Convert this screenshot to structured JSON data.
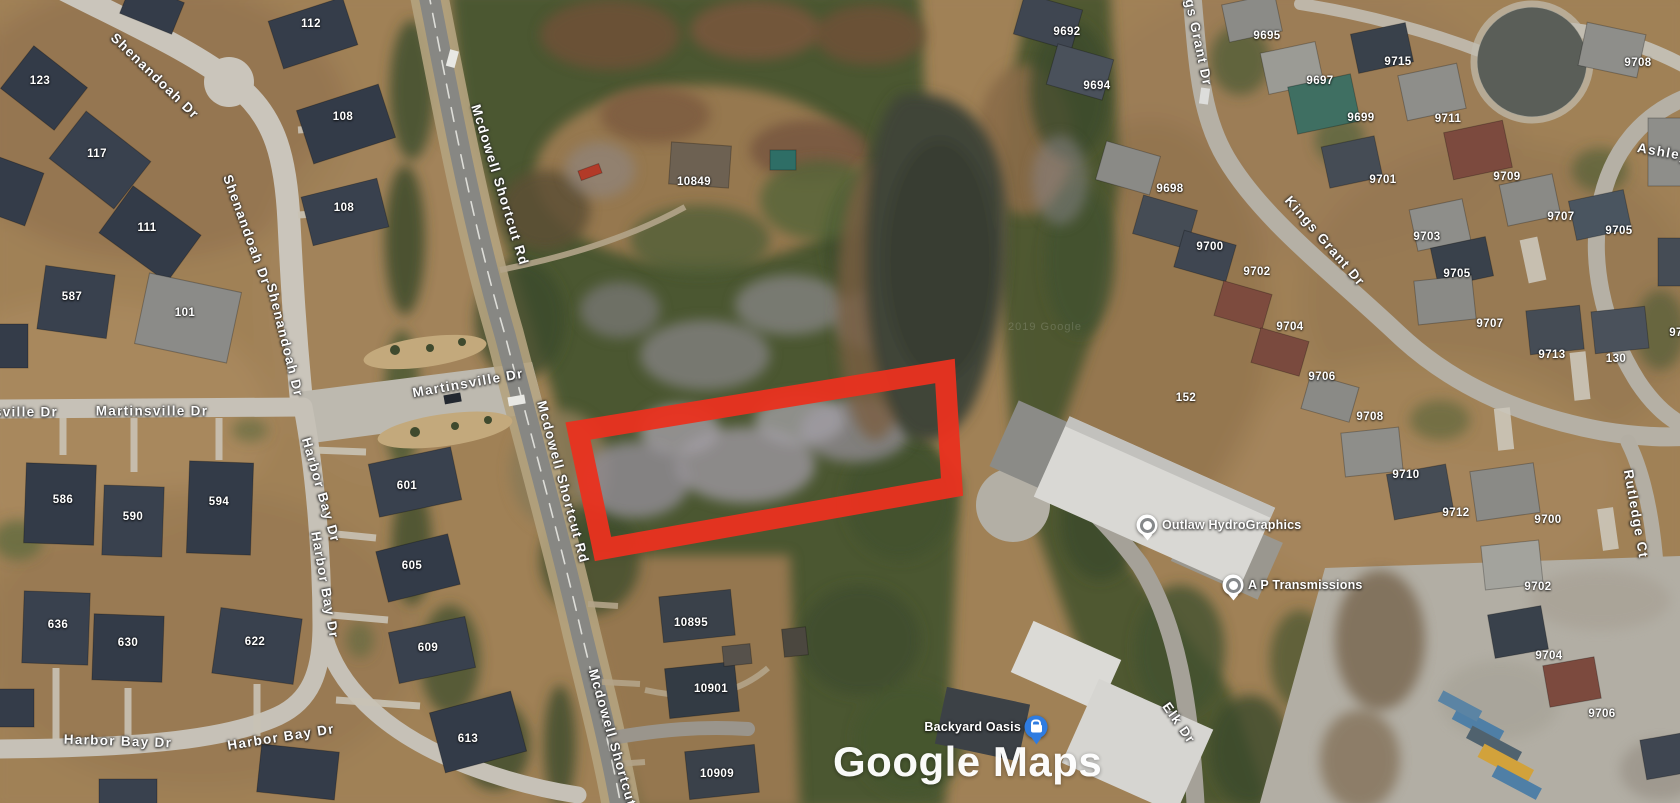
{
  "map": {
    "view_type": "satellite",
    "logo": {
      "text": "Google Maps"
    },
    "watermark": {
      "text": "2019 Google"
    },
    "street_labels": [
      {
        "text": "Shenandoah Dr",
        "x": 155,
        "y": 76,
        "rot": 44
      },
      {
        "text": "Shenandoah Dr",
        "x": 247,
        "y": 230,
        "rot": 70
      },
      {
        "text": "Shenandoah Dr",
        "x": 285,
        "y": 340,
        "rot": 76
      },
      {
        "text": "Mcdowell Shortcut Rd",
        "x": 500,
        "y": 185,
        "rot": 73
      },
      {
        "text": "Mcdowell Shortcut Rd",
        "x": 563,
        "y": 482,
        "rot": 75
      },
      {
        "text": "Mcdowell Shortcut Rd",
        "x": 616,
        "y": 750,
        "rot": 74
      },
      {
        "text": "sville Dr",
        "x": 26,
        "y": 412,
        "rot": 0
      },
      {
        "text": "Martinsville Dr",
        "x": 152,
        "y": 411,
        "rot": 0
      },
      {
        "text": "Martinsville Dr",
        "x": 468,
        "y": 383,
        "rot": -10
      },
      {
        "text": "Harbor Bay Dr",
        "x": 321,
        "y": 490,
        "rot": 74
      },
      {
        "text": "Harbor Bay Dr",
        "x": 325,
        "y": 585,
        "rot": 80
      },
      {
        "text": "Harbor Bay Dr",
        "x": 118,
        "y": 741,
        "rot": 2
      },
      {
        "text": "Harbor Bay Dr",
        "x": 281,
        "y": 737,
        "rot": -9
      },
      {
        "text": "Kings Grant Dr",
        "x": 1196,
        "y": 30,
        "rot": 78
      },
      {
        "text": "Kings Grant Dr",
        "x": 1325,
        "y": 241,
        "rot": 49
      },
      {
        "text": "Elk Dr",
        "x": 1179,
        "y": 723,
        "rot": 55
      },
      {
        "text": "Rutledge Ct",
        "x": 1636,
        "y": 514,
        "rot": 80
      },
      {
        "text": "Ashley",
        "x": 1663,
        "y": 152,
        "rot": 10
      }
    ],
    "house_numbers": [
      {
        "text": "112",
        "x": 311,
        "y": 24
      },
      {
        "text": "123",
        "x": 40,
        "y": 81
      },
      {
        "text": "117",
        "x": 97,
        "y": 154
      },
      {
        "text": "108",
        "x": 343,
        "y": 117
      },
      {
        "text": "108",
        "x": 344,
        "y": 208
      },
      {
        "text": "111",
        "x": 147,
        "y": 228
      },
      {
        "text": "587",
        "x": 72,
        "y": 297
      },
      {
        "text": "101",
        "x": 185,
        "y": 313
      },
      {
        "text": "586",
        "x": 63,
        "y": 500
      },
      {
        "text": "590",
        "x": 133,
        "y": 517
      },
      {
        "text": "594",
        "x": 219,
        "y": 502
      },
      {
        "text": "601",
        "x": 407,
        "y": 486
      },
      {
        "text": "605",
        "x": 412,
        "y": 566
      },
      {
        "text": "609",
        "x": 428,
        "y": 648
      },
      {
        "text": "613",
        "x": 468,
        "y": 739
      },
      {
        "text": "636",
        "x": 58,
        "y": 625
      },
      {
        "text": "630",
        "x": 128,
        "y": 643
      },
      {
        "text": "622",
        "x": 255,
        "y": 642
      },
      {
        "text": "10849",
        "x": 694,
        "y": 182
      },
      {
        "text": "10895",
        "x": 691,
        "y": 623
      },
      {
        "text": "10901",
        "x": 711,
        "y": 689
      },
      {
        "text": "10909",
        "x": 717,
        "y": 774
      },
      {
        "text": "9692",
        "x": 1067,
        "y": 32
      },
      {
        "text": "9694",
        "x": 1097,
        "y": 86
      },
      {
        "text": "9695",
        "x": 1267,
        "y": 36
      },
      {
        "text": "9697",
        "x": 1320,
        "y": 81
      },
      {
        "text": "9699",
        "x": 1361,
        "y": 118
      },
      {
        "text": "9715",
        "x": 1398,
        "y": 62
      },
      {
        "text": "9711",
        "x": 1448,
        "y": 119
      },
      {
        "text": "9708",
        "x": 1638,
        "y": 63
      },
      {
        "text": "9698",
        "x": 1170,
        "y": 189
      },
      {
        "text": "9700",
        "x": 1210,
        "y": 247
      },
      {
        "text": "9702",
        "x": 1257,
        "y": 272
      },
      {
        "text": "9701",
        "x": 1383,
        "y": 180
      },
      {
        "text": "9709",
        "x": 1507,
        "y": 177
      },
      {
        "text": "9707",
        "x": 1561,
        "y": 217
      },
      {
        "text": "9705",
        "x": 1619,
        "y": 231
      },
      {
        "text": "9703",
        "x": 1427,
        "y": 237
      },
      {
        "text": "9705",
        "x": 1457,
        "y": 274
      },
      {
        "text": "9704",
        "x": 1290,
        "y": 327
      },
      {
        "text": "9706",
        "x": 1322,
        "y": 377
      },
      {
        "text": "9708",
        "x": 1370,
        "y": 417
      },
      {
        "text": "152",
        "x": 1186,
        "y": 398
      },
      {
        "text": "9707",
        "x": 1490,
        "y": 324
      },
      {
        "text": "9713",
        "x": 1552,
        "y": 355
      },
      {
        "text": "130",
        "x": 1616,
        "y": 359
      },
      {
        "text": "97",
        "x": 1676,
        "y": 333
      },
      {
        "text": "9710",
        "x": 1406,
        "y": 475
      },
      {
        "text": "9712",
        "x": 1456,
        "y": 513
      },
      {
        "text": "9700",
        "x": 1548,
        "y": 520
      },
      {
        "text": "9702",
        "x": 1538,
        "y": 587
      },
      {
        "text": "9704",
        "x": 1549,
        "y": 656
      },
      {
        "text": "9706",
        "x": 1602,
        "y": 714
      }
    ],
    "places": [
      {
        "name": "Outlaw HydroGraphics",
        "pin": "white-dot",
        "pin_x": 1147,
        "pin_y": 525,
        "label_side": "right"
      },
      {
        "name": "A P Transmissions",
        "pin": "white-dot",
        "pin_x": 1233,
        "pin_y": 585,
        "label_side": "right"
      },
      {
        "name": "Backyard Oasis",
        "pin": "blue-shop",
        "pin_x": 1036,
        "pin_y": 727,
        "label_side": "left"
      }
    ],
    "parcel_outline": {
      "color": "#e8321f",
      "stroke_width": 21,
      "points": [
        [
          578,
          431
        ],
        [
          945,
          371
        ],
        [
          952,
          487
        ],
        [
          603,
          549
        ]
      ]
    }
  }
}
